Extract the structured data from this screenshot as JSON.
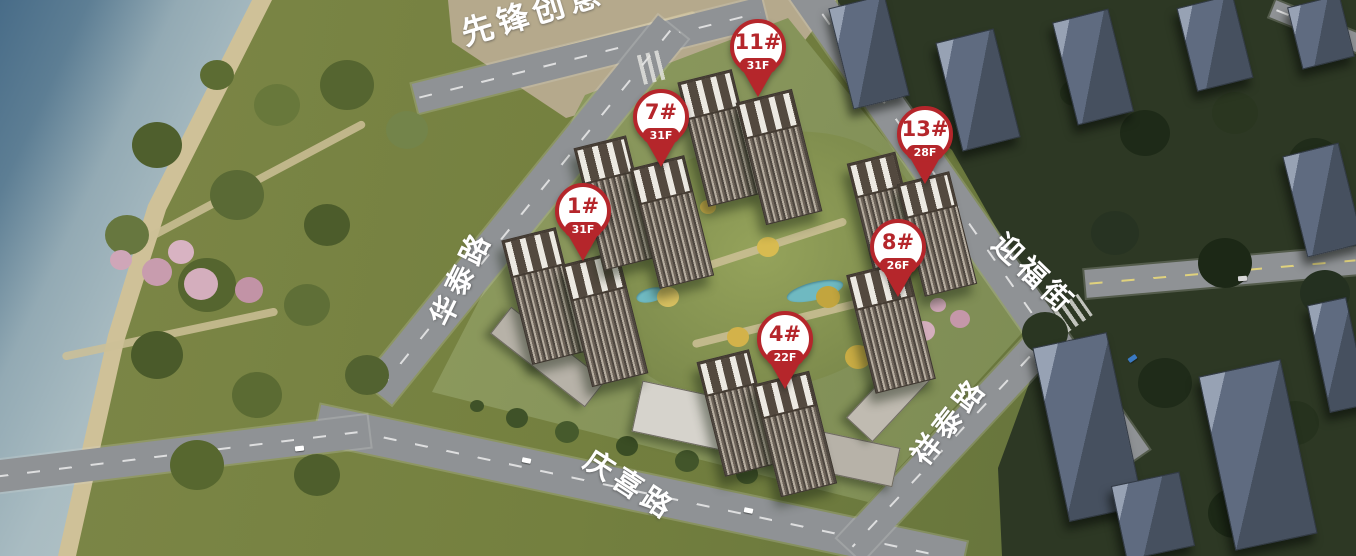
{
  "site_plan": {
    "building_pins": [
      {
        "label": "1#",
        "floors": "31F"
      },
      {
        "label": "7#",
        "floors": "31F"
      },
      {
        "label": "11#",
        "floors": "31F"
      },
      {
        "label": "13#",
        "floors": "28F"
      },
      {
        "label": "8#",
        "floors": "26F"
      },
      {
        "label": "4#",
        "floors": "22F"
      }
    ],
    "road_labels": [
      {
        "name": "先锋创意"
      },
      {
        "name": "华泰路"
      },
      {
        "name": "迎福街"
      },
      {
        "name": "祥泰路"
      },
      {
        "name": "庆喜路"
      }
    ],
    "colors": {
      "pin_red": "#b5262b",
      "pin_face": "#ffffff",
      "road_label": "#ffffff",
      "water": "#9fb3ba",
      "water_deep": "#486c88",
      "park_green": "#74803f",
      "courtyard_green": "#7c8a4c",
      "road_gray": "#8f9295",
      "context_building": "#5f6b80",
      "context_ground": "#2d3824"
    }
  }
}
